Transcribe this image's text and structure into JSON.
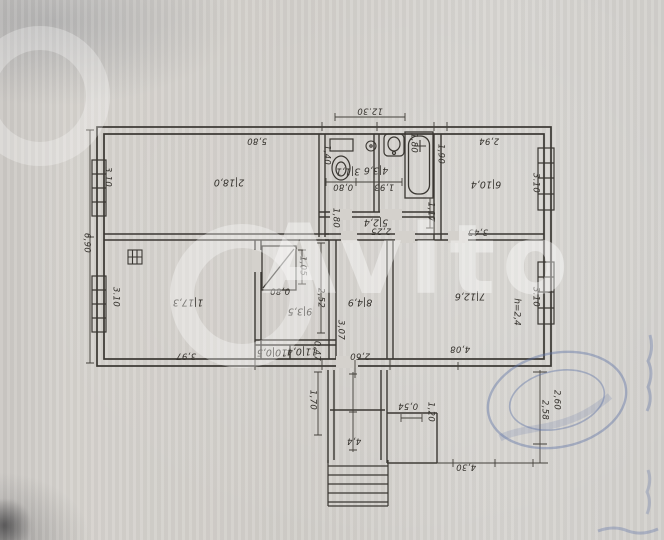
{
  "watermark": {
    "text": "Avito"
  },
  "colors": {
    "paper": "#d4d1cc",
    "ink": "#35322d",
    "stamp_blue": "#5b6fa5",
    "note_red": "#b2403a"
  },
  "plan": {
    "overall": {
      "width_label": "12.30",
      "height_label": "6,90"
    },
    "rooms": [
      {
        "number": "1",
        "area": "17,3",
        "x": 188,
        "y": 302
      },
      {
        "number": "2",
        "area": "18,0",
        "x": 229,
        "y": 182
      },
      {
        "number": "3",
        "area": "1,1",
        "x": 348,
        "y": 171
      },
      {
        "number": "4",
        "area": "3,6",
        "x": 376,
        "y": 170
      },
      {
        "number": "5",
        "area": "2,4",
        "x": 376,
        "y": 222
      },
      {
        "number": "6",
        "area": "10,4",
        "x": 486,
        "y": 184
      },
      {
        "number": "7",
        "area": "12,6",
        "x": 470,
        "y": 296
      },
      {
        "number": "8",
        "area": "4,9",
        "x": 360,
        "y": 302
      },
      {
        "number": "9",
        "area": "3,5",
        "x": 300,
        "y": 311
      },
      {
        "number": "10",
        "area": "0,5",
        "x": 272,
        "y": 352
      },
      {
        "number": "11",
        "area": "0,4",
        "x": 302,
        "y": 351
      }
    ],
    "dimensions": [
      {
        "t": "12.30",
        "x": 370,
        "y": 111,
        "r": 180
      },
      {
        "t": "5,80",
        "x": 257,
        "y": 141,
        "r": 180
      },
      {
        "t": "2,94",
        "x": 489,
        "y": 141,
        "r": 180
      },
      {
        "t": "3.10",
        "x": 108,
        "y": 177,
        "r": 90
      },
      {
        "t": "6,90",
        "x": 87,
        "y": 243,
        "r": 90
      },
      {
        "t": "3.10",
        "x": 116,
        "y": 297,
        "r": 90
      },
      {
        "t": "1,90",
        "x": 441,
        "y": 154,
        "r": 90
      },
      {
        "t": "3.10",
        "x": 536,
        "y": 183,
        "r": 90
      },
      {
        "t": "3.10",
        "x": 536,
        "y": 297,
        "r": 90
      },
      {
        "t": "1,40",
        "x": 327,
        "y": 155,
        "r": 90
      },
      {
        "t": "1,80",
        "x": 414,
        "y": 143,
        "r": 90
      },
      {
        "t": "0,80",
        "x": 343,
        "y": 187,
        "r": 180
      },
      {
        "t": "1,93",
        "x": 384,
        "y": 187,
        "r": 180
      },
      {
        "t": "2,25",
        "x": 381,
        "y": 231,
        "r": 180
      },
      {
        "t": "1,80",
        "x": 336,
        "y": 218,
        "r": 90
      },
      {
        "t": "1,17",
        "x": 431,
        "y": 212,
        "r": 90
      },
      {
        "t": "3,45",
        "x": 478,
        "y": 232,
        "r": 180
      },
      {
        "t": "1,05",
        "x": 303,
        "y": 266,
        "r": 90
      },
      {
        "t": "0,80",
        "x": 280,
        "y": 291,
        "r": 180
      },
      {
        "t": "2,52",
        "x": 321,
        "y": 298,
        "r": 90
      },
      {
        "t": "3,07",
        "x": 341,
        "y": 330,
        "r": 90
      },
      {
        "t": "0,47",
        "x": 317,
        "y": 351,
        "r": 90
      },
      {
        "t": "3,97",
        "x": 186,
        "y": 356,
        "r": 180
      },
      {
        "t": "2,60",
        "x": 360,
        "y": 356,
        "r": 180
      },
      {
        "t": "4,08",
        "x": 460,
        "y": 349,
        "r": 180
      },
      {
        "t": "1,70",
        "x": 313,
        "y": 400,
        "r": 90
      },
      {
        "t": "4,4",
        "x": 354,
        "y": 441,
        "r": 180
      },
      {
        "t": "0,54",
        "x": 408,
        "y": 406,
        "r": 180
      },
      {
        "t": "1,20",
        "x": 431,
        "y": 412,
        "r": 90
      },
      {
        "t": "4,30",
        "x": 466,
        "y": 467,
        "r": 180
      },
      {
        "t": "2,58",
        "x": 545,
        "y": 410,
        "r": 90
      },
      {
        "t": "2,60",
        "x": 557,
        "y": 400,
        "r": 90
      }
    ],
    "notes": [
      {
        "t": "h=2,4",
        "x": 517,
        "y": 312,
        "r": 90,
        "color": "#b2403a"
      }
    ]
  }
}
